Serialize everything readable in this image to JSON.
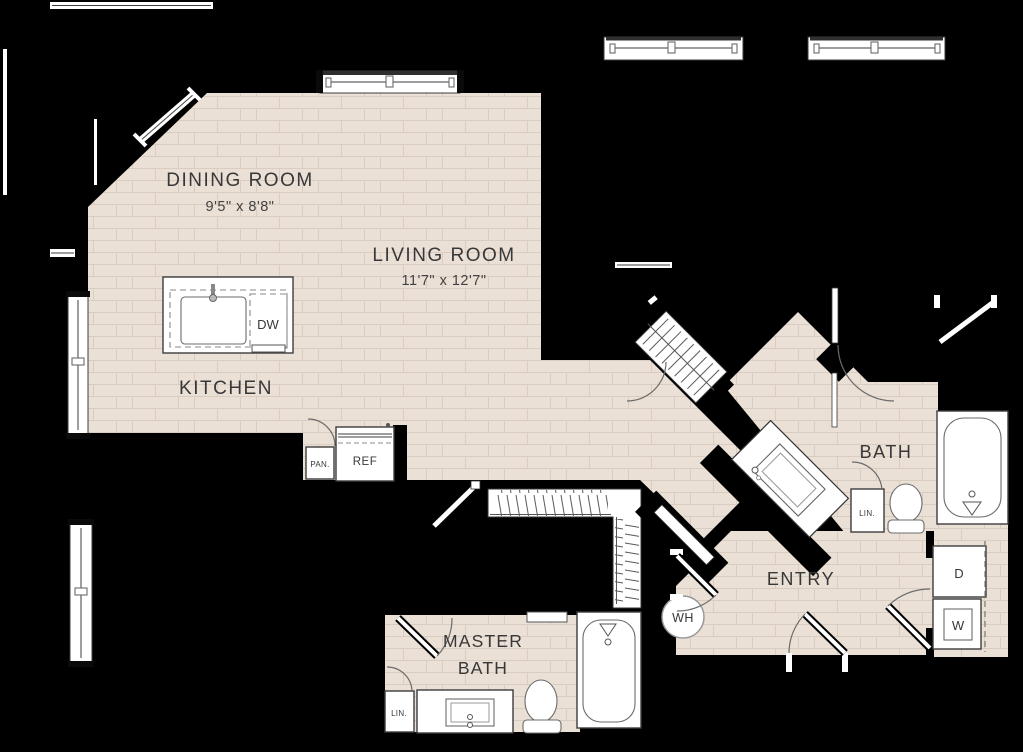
{
  "colors": {
    "background": "#000000",
    "floor": "#eae0d6",
    "brick_line": "#d9ccc0",
    "fixture_white": "#ffffff",
    "text": "#383838"
  },
  "rooms": {
    "dining": {
      "label": "DINING ROOM",
      "dims": "9'5\" x 8'8\""
    },
    "living": {
      "label": "LIVING ROOM",
      "dims": "11'7\" x 12'7\""
    },
    "kitchen": {
      "label": "KITCHEN"
    },
    "bath": {
      "label": "BATH"
    },
    "entry": {
      "label": "ENTRY"
    },
    "master_bath": {
      "label_line1": "MASTER",
      "label_line2": "BATH"
    }
  },
  "fixtures": {
    "refrigerator": "REF",
    "pantry": "PAN.",
    "dishwasher": "DW",
    "water_heater": "WH",
    "dryer": "D",
    "washer": "W",
    "linen_bath": "LIN.",
    "linen_master": "LIN."
  }
}
